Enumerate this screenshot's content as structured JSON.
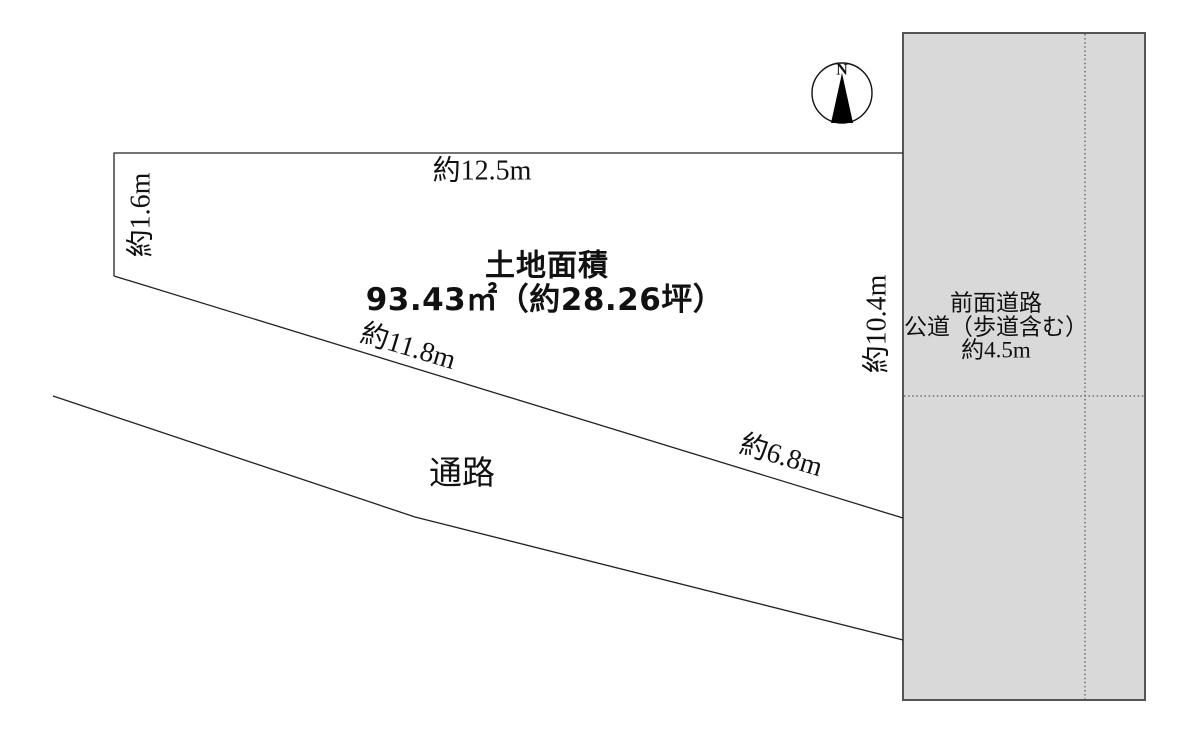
{
  "plot": {
    "area_title": "土地面積",
    "area_value": "93.43㎡（約28.26坪）",
    "dim_top": "約12.5m",
    "dim_left": "約1.6m",
    "dim_bottom_left": "約11.8m",
    "dim_bottom_right": "約6.8m",
    "dim_right": "約10.4m"
  },
  "passage": {
    "label": "通路"
  },
  "road": {
    "line1": "前面道路",
    "line2": "公道（歩道含む）",
    "line3": "約4.5m",
    "fill": "#d9d9d9",
    "border": "#555555"
  },
  "compass": {
    "label": "N"
  },
  "colors": {
    "background": "#ffffff",
    "line": "#222222",
    "text": "#111111"
  }
}
